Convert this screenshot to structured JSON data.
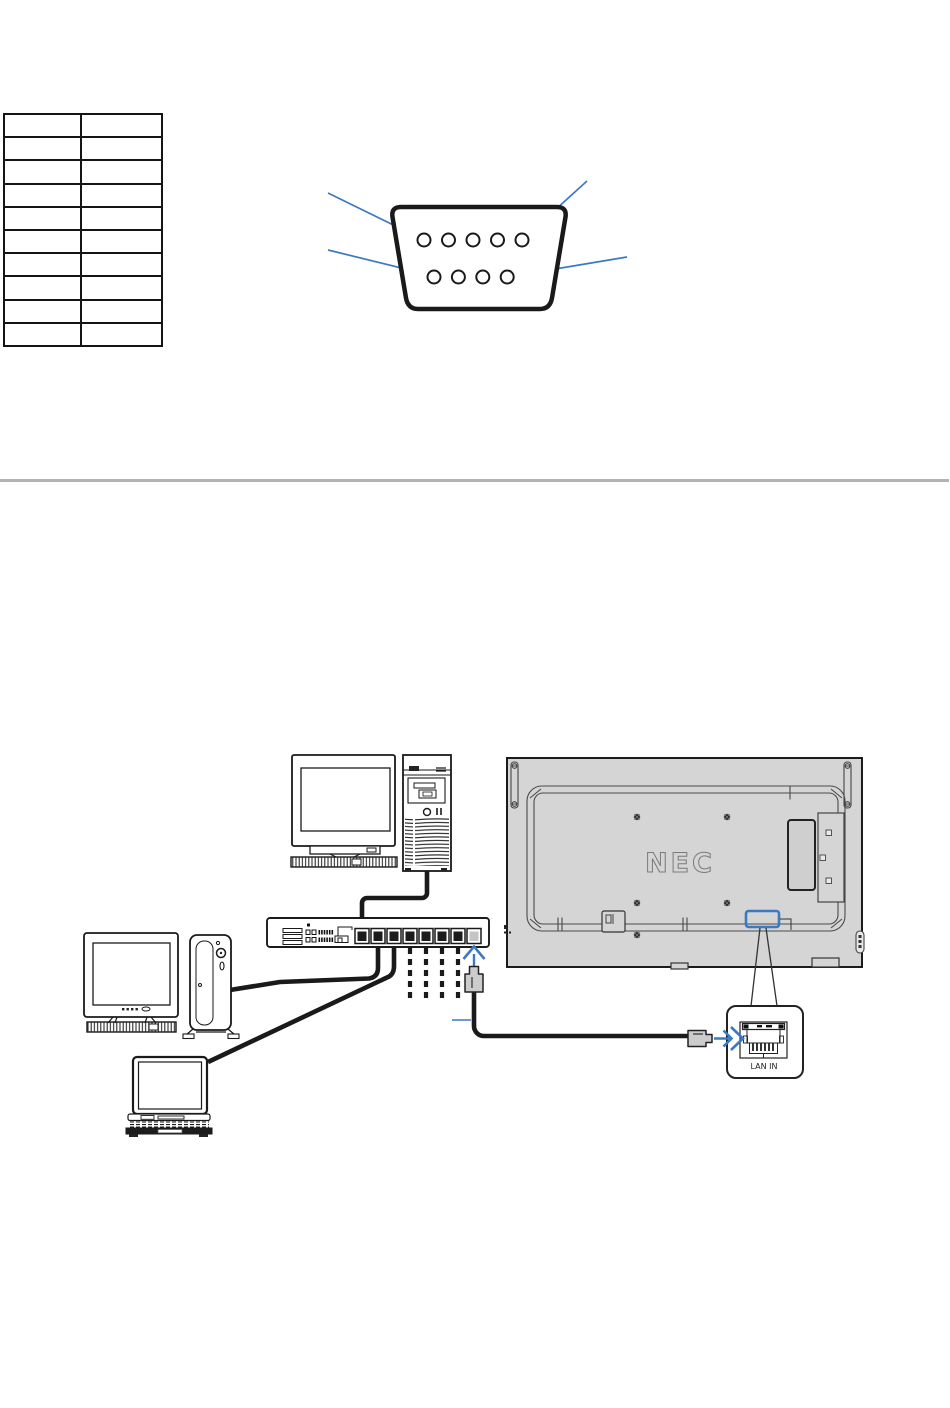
{
  "page": {
    "background": "#ffffff"
  },
  "colors": {
    "accent_blue": "#3b79c2",
    "panel_gray": "#d5d5d5",
    "divider_gray": "#b3b3b3",
    "line_black": "#1a1a1a"
  },
  "pin_table": {
    "rows": 10,
    "columns": 2,
    "cells_empty": true
  },
  "dsub_connector": {
    "top_pin_count": 5,
    "bottom_pin_count": 4,
    "callout_line_count": 4
  },
  "network_diagram": {
    "display": {
      "brand_label": "NEC",
      "lan_port_label": "LAN IN"
    },
    "hub": {
      "port_count": 8,
      "dashed_drop_ports": [
        4,
        5,
        6,
        7
      ]
    },
    "devices": [
      "desktop-computer-with-tower",
      "desktop-computer-with-slim-tower",
      "laptop"
    ]
  }
}
